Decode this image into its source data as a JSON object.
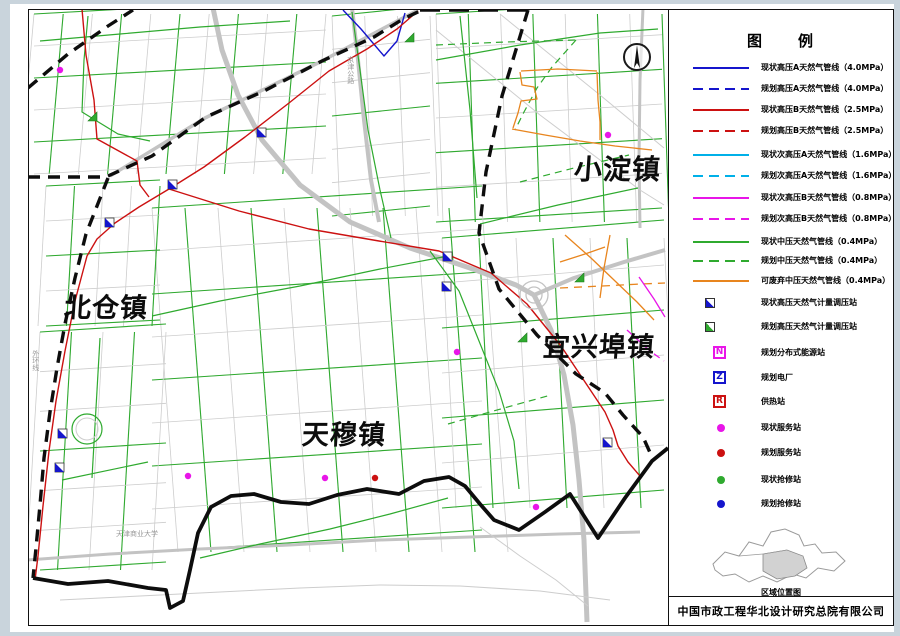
{
  "page": {
    "legend_title": "图　　例",
    "inset_caption": "区域位置图",
    "company": "中国市政工程华北设计研究总院有限公司"
  },
  "colors": {
    "blue": "#1515cc",
    "red": "#cc1111",
    "cyan": "#00b0e8",
    "magenta": "#e815e8",
    "green": "#2faa2f",
    "orange": "#e8851e",
    "boundary": "#0d0d0d",
    "road": "#cdcdcd",
    "road_wide": "#c3c3c3"
  },
  "legend": {
    "items": [
      {
        "type": "line",
        "color": "blue",
        "dash": false,
        "label": "现状高压A天然气管线（4.0MPa）",
        "top": 58
      },
      {
        "type": "line",
        "color": "blue",
        "dash": true,
        "label": "规划高压A天然气管线（4.0MPa）",
        "top": 79
      },
      {
        "type": "line",
        "color": "red",
        "dash": false,
        "label": "现状高压B天然气管线（2.5MPa）",
        "top": 100
      },
      {
        "type": "line",
        "color": "red",
        "dash": true,
        "label": "规划高压B天然气管线（2.5MPa）",
        "top": 121
      },
      {
        "type": "line",
        "color": "cyan",
        "dash": false,
        "label": "现状次高压A天然气管线（1.6MPa）",
        "top": 145
      },
      {
        "type": "line",
        "color": "cyan",
        "dash": true,
        "label": "规划次高压A天然气管线（1.6MPa）",
        "top": 166
      },
      {
        "type": "line",
        "color": "magenta",
        "dash": false,
        "label": "现状次高压B天然气管线（0.8MPa）",
        "top": 188
      },
      {
        "type": "line",
        "color": "magenta",
        "dash": true,
        "label": "规划次高压B天然气管线（0.8MPa）",
        "top": 209
      },
      {
        "type": "line",
        "color": "green",
        "dash": false,
        "label": "现状中压天然气管线（0.4MPa）",
        "top": 232
      },
      {
        "type": "line",
        "color": "green",
        "dash": true,
        "label": "规划中压天然气管线（0.4MPa）",
        "top": 251
      },
      {
        "type": "line",
        "color": "orange",
        "dash": false,
        "label": "可废弃中压天然气管线（0.4MPa）",
        "top": 271
      },
      {
        "type": "flag",
        "color": "blue",
        "label": "现状高压天然气计量调压站",
        "top": 293
      },
      {
        "type": "flag",
        "color": "green",
        "label": "规划高压天然气计量调压站",
        "top": 317
      },
      {
        "type": "box",
        "color": "magenta",
        "glyph": "N",
        "label": "规划分布式能源站",
        "top": 343
      },
      {
        "type": "box",
        "color": "blue",
        "glyph": "Z",
        "label": "规划电厂",
        "top": 368
      },
      {
        "type": "box",
        "color": "red",
        "glyph": "R",
        "label": "供热站",
        "top": 392
      },
      {
        "type": "dot",
        "color": "magenta",
        "label": "现状服务站",
        "top": 418
      },
      {
        "type": "dot",
        "color": "red",
        "label": "规划服务站",
        "top": 443
      },
      {
        "type": "dot",
        "color": "green",
        "label": "现状抢修站",
        "top": 470
      },
      {
        "type": "dot",
        "color": "blue",
        "label": "规划抢修站",
        "top": 494
      }
    ]
  },
  "map": {
    "towns": [
      {
        "name": "北仓镇",
        "x": 64,
        "y": 295,
        "size": 27
      },
      {
        "name": "天穆镇",
        "x": 302,
        "y": 422,
        "size": 27
      },
      {
        "name": "小淀镇",
        "x": 574,
        "y": 156,
        "size": 28
      },
      {
        "name": "宜兴埠镇",
        "x": 543,
        "y": 334,
        "size": 27
      }
    ],
    "road_labels": [
      {
        "text": "外环线",
        "x": 31,
        "y": 350,
        "vertical": true
      },
      {
        "text": "京津公路",
        "x": 346,
        "y": 56,
        "vertical": true
      },
      {
        "text": "天津商业大学",
        "x": 116,
        "y": 531,
        "vertical": false
      }
    ],
    "grids": [
      {
        "x": 34,
        "y": 14,
        "w": 292,
        "h": 160,
        "nx": 10,
        "ny": 5,
        "sx": -14,
        "sy": -16,
        "gv": 2,
        "gh": 2
      },
      {
        "x": 332,
        "y": 16,
        "w": 98,
        "h": 200,
        "nx": 3,
        "ny": 6,
        "sx": 8,
        "sy": -10,
        "gv": 0,
        "gh": 3
      },
      {
        "x": 436,
        "y": 14,
        "w": 226,
        "h": 208,
        "nx": 7,
        "ny": 6,
        "sx": 7,
        "sy": -14,
        "gv": 2,
        "gh": 2
      },
      {
        "x": 152,
        "y": 208,
        "w": 330,
        "h": 344,
        "nx": 10,
        "ny": 8,
        "sx": 26,
        "sy": -22,
        "gv": 2,
        "gh": 2
      },
      {
        "x": 442,
        "y": 238,
        "w": 222,
        "h": 270,
        "nx": 6,
        "ny": 6,
        "sx": 14,
        "sy": -18,
        "gv": 2,
        "gh": 2
      },
      {
        "x": 40,
        "y": 332,
        "w": 126,
        "h": 238,
        "nx": 4,
        "ny": 6,
        "sx": -14,
        "sy": -8,
        "gv": 2,
        "gh": 3
      },
      {
        "x": 46,
        "y": 186,
        "w": 114,
        "h": 140,
        "nx": 4,
        "ny": 4,
        "sx": -8,
        "sy": -6,
        "gv": 3,
        "gh": 2
      }
    ],
    "paths": [
      {
        "name": "wide-road",
        "color": "road_wide",
        "w": 5,
        "dash": null,
        "pts": "213,8 222,50 238,95 262,140 300,185 350,222 410,248 470,268 516,285 534,295"
      },
      {
        "name": "wide-road",
        "color": "road_wide",
        "w": 5,
        "dash": null,
        "pts": "534,295 551,330 564,375 573,425 579,480 584,540 587,622"
      },
      {
        "name": "wide-road",
        "color": "road_wide",
        "w": 4,
        "dash": null,
        "pts": "534,295 574,278 624,262 665,250"
      },
      {
        "name": "wide-road",
        "color": "road_wide",
        "w": 4,
        "dash": null,
        "pts": "352,8 358,60 364,120 371,180 379,222"
      },
      {
        "name": "wide-road",
        "color": "road_wide",
        "w": 3.5,
        "dash": null,
        "pts": "110,176 205,118 320,62 418,10"
      },
      {
        "name": "wide-road",
        "color": "road_wide",
        "w": 3,
        "dash": null,
        "pts": "28,560 110,554 200,549 290,545 380,540 470,537 560,534 640,532"
      },
      {
        "name": "wide-road",
        "color": "road_wide",
        "w": 3,
        "dash": null,
        "pts": "643,8 640,80 639,160 640,228"
      },
      {
        "name": "road-diagonal",
        "color": "road",
        "w": 1,
        "dash": null,
        "pts": "436,30 540,115 640,190 664,205"
      },
      {
        "name": "road-diagonal",
        "color": "road",
        "w": 1,
        "dash": null,
        "pts": "500,14 600,95 664,148"
      },
      {
        "name": "road-south",
        "color": "road",
        "w": 1,
        "dash": null,
        "pts": "60,600 140,596 220,592 300,588 380,585 460,586 540,591 610,600"
      },
      {
        "name": "road-south",
        "color": "road",
        "w": 1,
        "dash": null,
        "pts": "480,527 520,556 556,580 588,606"
      },
      {
        "name": "pipeline-mid-green",
        "color": "green",
        "w": 1.2,
        "dash": null,
        "pts": "88,16 84,60 82,112 118,134 150,141"
      },
      {
        "name": "pipeline-mid-green",
        "color": "green",
        "w": 1.2,
        "dash": null,
        "pts": "40,41 120,34 200,27 290,21"
      },
      {
        "name": "pipeline-mid-green",
        "color": "green",
        "w": 1.2,
        "dash": null,
        "pts": "352,12 360,70 368,130 380,190 391,238"
      },
      {
        "name": "pipeline-mid-green",
        "color": "green",
        "w": 1.2,
        "dash": null,
        "pts": "430,251 459,291 479,341 499,391 514,441 519,489"
      },
      {
        "name": "pipeline-mid-green",
        "color": "green",
        "w": 1.2,
        "dash": null,
        "pts": "152,316 220,301 300,286 380,269 448,256"
      },
      {
        "name": "pipeline-mid-green",
        "color": "green",
        "w": 1.2,
        "dash": null,
        "pts": "200,558 260,544 330,529 390,514 448,498"
      },
      {
        "name": "pipeline-mid-green",
        "color": "green",
        "w": 1.2,
        "dash": null,
        "pts": "460,16 470,110 477,198"
      },
      {
        "name": "pipeline-mid-green",
        "color": "green",
        "w": 1.2,
        "dash": null,
        "pts": "480,224 558,205 638,188"
      },
      {
        "name": "pipeline-mid-green",
        "color": "green",
        "w": 1.2,
        "dash": null,
        "pts": "436,60 520,45 600,33 658,29"
      },
      {
        "name": "pipeline-mid-green",
        "color": "green",
        "w": 1.2,
        "dash": null,
        "pts": "62,480 148,462"
      },
      {
        "name": "pipeline-mid-green",
        "color": "green",
        "w": 1.2,
        "dash": null,
        "pts": "100,338 92,478"
      },
      {
        "name": "pipeline-planned-green",
        "color": "green",
        "w": 1.2,
        "dash": "7 5",
        "pts": "436,45 505,42 576,40"
      },
      {
        "name": "pipeline-planned-green",
        "color": "green",
        "w": 1.2,
        "dash": "7 5",
        "pts": "576,40 552,67 537,88 524,112 515,130"
      },
      {
        "name": "pipeline-planned-green",
        "color": "green",
        "w": 1.2,
        "dash": "7 5",
        "pts": "520,182 574,168 629,155"
      },
      {
        "name": "pipeline-planned-green",
        "color": "green",
        "w": 1.2,
        "dash": "7 5",
        "pts": "448,424 504,408 551,395"
      },
      {
        "name": "pipeline-abandon-orange",
        "color": "orange",
        "w": 1.3,
        "dash": null,
        "pts": "520,72 522,85 534,87 537,99 521,101 518,113 513,128"
      },
      {
        "name": "pipeline-abandon-orange",
        "color": "orange",
        "w": 1.3,
        "dash": null,
        "pts": "597,72 598,100 600,122 600,140"
      },
      {
        "name": "pipeline-abandon-orange",
        "color": "orange",
        "w": 1.3,
        "dash": null,
        "pts": "512,129 545,135 580,141 615,146 652,150"
      },
      {
        "name": "pipeline-abandon-orange",
        "color": "orange",
        "w": 1.3,
        "dash": null,
        "pts": "521,71 558,69 597,71"
      },
      {
        "name": "pipeline-abandon-orange",
        "color": "orange",
        "w": 1.3,
        "dash": null,
        "pts": "565,235 591,258 614,280 637,302 654,320"
      },
      {
        "name": "pipeline-abandon-orange",
        "color": "orange",
        "w": 1.3,
        "dash": null,
        "pts": "610,235 604,268 600,298"
      },
      {
        "name": "pipeline-abandon-orange",
        "color": "orange",
        "w": 1.3,
        "dash": null,
        "pts": "560,262 585,254 605,247"
      },
      {
        "name": "pipeline-orange-dashed",
        "color": "orange",
        "w": 1.3,
        "dash": "8 6",
        "pts": "560,288 602,286 641,284 665,283"
      },
      {
        "name": "pipeline-subhigh-magenta",
        "color": "magenta",
        "w": 1.3,
        "dash": null,
        "pts": "639,277 654,299 665,317"
      },
      {
        "name": "pipeline-subhigh-magenta",
        "color": "magenta",
        "w": 1.3,
        "dash": "7 5",
        "pts": "627,330 650,351 664,361"
      },
      {
        "name": "pipeline-high-blue",
        "color": "blue",
        "w": 1.4,
        "dash": null,
        "pts": "343,10 361,29 384,56 397,41 405,13"
      },
      {
        "name": "pipeline-high-red",
        "color": "red",
        "w": 1.4,
        "dash": null,
        "pts": "418,11 397,29 367,49 329,71 289,103 245,137 204,167 169,189 139,207 115,223 97,239 87,256 75,301 65,351 56,401 49,451 43,506 38,556 35,580"
      },
      {
        "name": "pipeline-high-red",
        "color": "red",
        "w": 1.4,
        "dash": null,
        "pts": "82,9 86,55 94,100 97,139 137,161 140,185 149,197"
      },
      {
        "name": "pipeline-high-red",
        "color": "red",
        "w": 1.4,
        "dash": null,
        "pts": "169,189 239,211 309,229 379,241 439,251 491,273 527,304 561,346 591,391 605,412 613,430 618,446 628,462 640,476"
      },
      {
        "name": "boundary-line",
        "color": "boundary",
        "w": 3.4,
        "dash": "12 8",
        "pts": "28,88 68,54 108,26 133,10"
      },
      {
        "name": "boundary-line",
        "color": "boundary",
        "w": 3.4,
        "dash": "12 8",
        "pts": "28,177 108,177"
      },
      {
        "name": "boundary-line",
        "color": "boundary",
        "w": 3.4,
        "dash": "12 8",
        "pts": "108,178 97,206 86,234 75,278 65,324 57,368 50,412 44,458 40,505 36,548 33,578"
      },
      {
        "name": "boundary-line",
        "color": "boundary",
        "w": 3.4,
        "dash": "12 8",
        "pts": "108,176 152,156 206,117 264,91 322,61 374,37 403,19 420,11"
      },
      {
        "name": "boundary-line",
        "color": "boundary",
        "w": 3.4,
        "dash": "20 9",
        "pts": "420,10 528,10"
      },
      {
        "name": "boundary-line",
        "color": "boundary",
        "w": 3.4,
        "dash": "12 8",
        "pts": "528,10 502,96 486,172 479,233 499,289 537,335 576,374 605,393 623,415 643,437 652,457"
      },
      {
        "name": "boundary-solid",
        "color": "boundary",
        "w": 3.8,
        "dash": null,
        "pts": "33,578 68,584 108,581 148,588 166,590 170,608 183,601 190,570 198,533 211,507 231,496 254,494 281,502 309,504 337,495 367,489 399,494 424,481 449,477 465,486 480,504 494,520 519,530 545,512 570,494 584,516 598,538 625,498 652,461 668,448"
      }
    ],
    "circles": [
      {
        "x": 534,
        "y": 295,
        "r": 14,
        "color": "road_wide",
        "w": 1.3
      },
      {
        "x": 534,
        "y": 295,
        "r": 8,
        "color": "road_wide",
        "w": 1.3
      },
      {
        "x": 87,
        "y": 429,
        "r": 15,
        "color": "green",
        "w": 1.2
      },
      {
        "x": 87,
        "y": 429,
        "r": 11,
        "color": "road",
        "w": 1
      }
    ],
    "flags": [
      {
        "color": "blue",
        "x": 257,
        "y": 128
      },
      {
        "color": "blue",
        "x": 168,
        "y": 180
      },
      {
        "color": "blue",
        "x": 105,
        "y": 218
      },
      {
        "color": "blue",
        "x": 443,
        "y": 252
      },
      {
        "color": "blue",
        "x": 442,
        "y": 282
      },
      {
        "color": "blue",
        "x": 58,
        "y": 429
      },
      {
        "color": "blue",
        "x": 55,
        "y": 463
      },
      {
        "color": "blue",
        "x": 603,
        "y": 438
      },
      {
        "color": "green",
        "x": 405,
        "y": 33
      },
      {
        "color": "green",
        "x": 88,
        "y": 112
      },
      {
        "color": "green",
        "x": 575,
        "y": 273
      },
      {
        "color": "green",
        "x": 518,
        "y": 333
      }
    ],
    "dots": [
      {
        "color": "magenta",
        "x": 60,
        "y": 70
      },
      {
        "color": "magenta",
        "x": 325,
        "y": 478
      },
      {
        "color": "magenta",
        "x": 188,
        "y": 476
      },
      {
        "color": "magenta",
        "x": 608,
        "y": 135
      },
      {
        "color": "magenta",
        "x": 457,
        "y": 352
      },
      {
        "color": "magenta",
        "x": 536,
        "y": 507
      },
      {
        "color": "red",
        "x": 375,
        "y": 478
      }
    ],
    "north_arrow": {
      "x": 637,
      "y": 57,
      "r": 13
    }
  }
}
